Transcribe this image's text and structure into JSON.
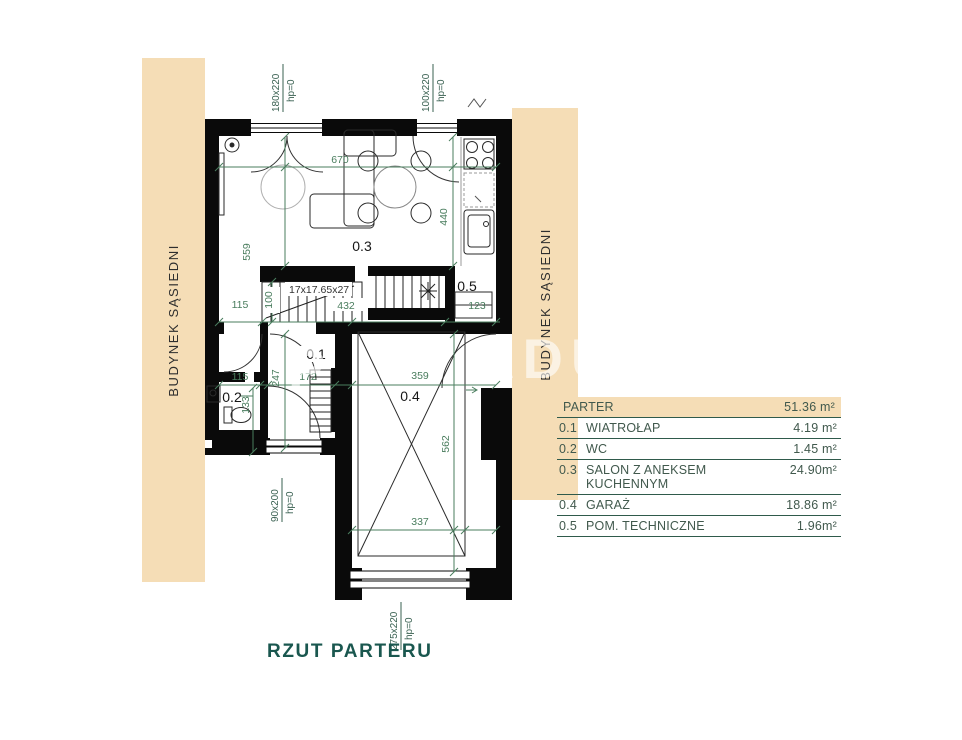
{
  "page": {
    "title": "RZUT PARTERU",
    "watermark_left": "P",
    "watermark_right": "ADU"
  },
  "neighbors": {
    "left": "BUDYNEK SĄSIEDNI",
    "right": "BUDYNEK SĄSIEDNI"
  },
  "rooms": {
    "r01": "0.1",
    "r02": "0.2",
    "r03": "0.3",
    "r04": "0.4",
    "r05": "0.5"
  },
  "stairs": {
    "spec": "17x17.65x27"
  },
  "dims": {
    "w670": "670",
    "h559": "559",
    "h440": "440",
    "w115a": "115",
    "h100": "100",
    "w432": "432",
    "w123": "123",
    "w115b": "115",
    "h247": "247",
    "w172": "172",
    "w359": "359",
    "h133": "133",
    "h562": "562",
    "w337": "337"
  },
  "openings": {
    "w180": {
      "size": "180x220",
      "hp": "hp=0"
    },
    "w100": {
      "size": "100x220",
      "hp": "hp=0"
    },
    "w90": {
      "size": "90x200",
      "hp": "hp=0"
    },
    "w275": {
      "size": "275x220",
      "hp": "hp=0"
    }
  },
  "legend": {
    "header": {
      "name": "PARTER",
      "area": "51.36 m²"
    },
    "rows": [
      {
        "no": "0.1",
        "name": "WIATROŁAP",
        "area": "4.19 m²"
      },
      {
        "no": "0.2",
        "name": "WC",
        "area": "1.45 m²"
      },
      {
        "no": "0.3",
        "name": "SALON Z ANEKSEM KUCHENNYM",
        "area": "24.90m²"
      },
      {
        "no": "0.4",
        "name": "GARAŻ",
        "area": "18.86 m²"
      },
      {
        "no": "0.5",
        "name": "POM. TECHNICZNE",
        "area": "1.96m²"
      }
    ]
  },
  "colors": {
    "beige": "#f5ddb6",
    "dim_green": "#4a7d5e",
    "wall": "#0a0a0a",
    "teal": "#1a574f"
  }
}
